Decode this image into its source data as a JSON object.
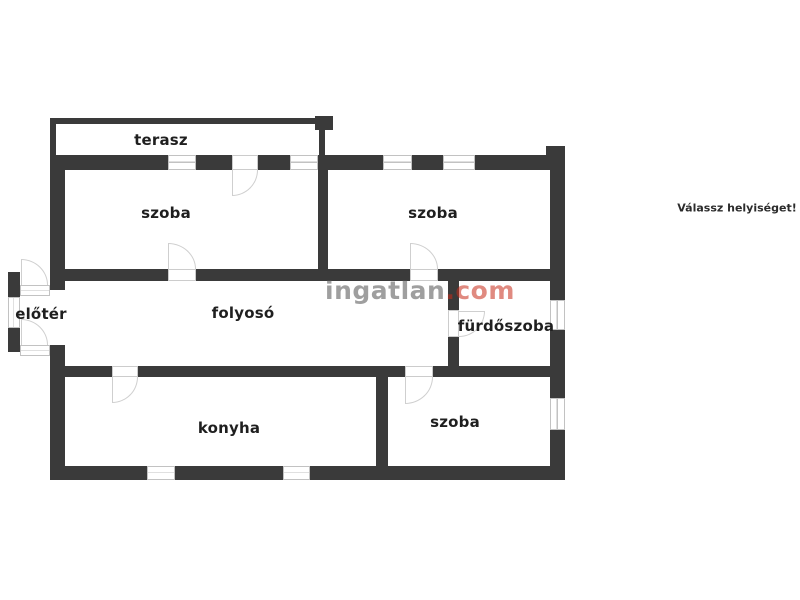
{
  "prompt": {
    "label": "Válassz helyiséget!"
  },
  "watermark": {
    "brand": "ingatlan",
    "tld": ".com"
  },
  "rooms": {
    "terasz": {
      "label": "terasz"
    },
    "szoba_top_left": {
      "label": "szoba"
    },
    "szoba_top_right": {
      "label": "szoba"
    },
    "eloter": {
      "label": "előtér"
    },
    "folyoso": {
      "label": "folyosó"
    },
    "furdoszoba": {
      "label": "fürdőszoba"
    },
    "konyha": {
      "label": "konyha"
    },
    "szoba_bottom": {
      "label": "szoba"
    }
  },
  "colors": {
    "wall": "#3a3a3a",
    "window_frame": "#c2c2c2",
    "door_arc": "#cfcfcf",
    "label_text": "#1f1f1f",
    "watermark_gray": "#9e9e9e",
    "watermark_red": "#e0897f",
    "background": "#ffffff"
  }
}
